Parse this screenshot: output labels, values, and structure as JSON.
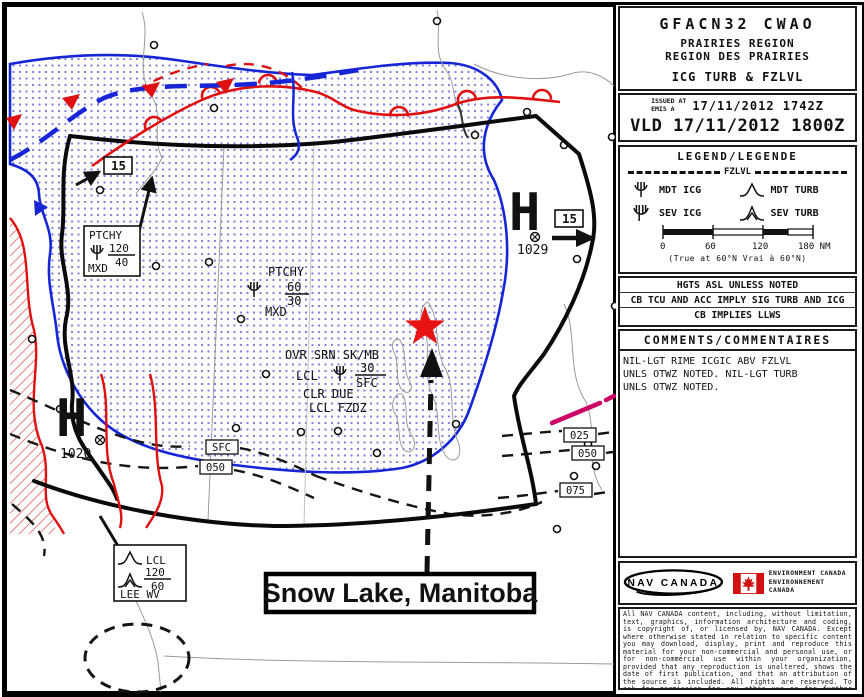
{
  "header": {
    "id": "GFACN32 CWAO",
    "region_en": "PRAIRIES REGION",
    "region_fr": "REGION DES PRAIRIES",
    "product": "ICG TURB & FZLVL",
    "issued_label": "ISSUED AT\nEMIS A",
    "issued_value": "17/11/2012 1742Z",
    "valid": "VLD 17/11/2012 1800Z"
  },
  "legend": {
    "title": "LEGEND/LEGENDE",
    "fzlvl": "FZLVL",
    "mdt_icg": "MDT ICG",
    "mdt_turb": "MDT TURB",
    "sev_icg": "SEV ICG",
    "sev_turb": "SEV TURB",
    "ticks": [
      "0",
      "60",
      "120",
      "180 NM"
    ],
    "note": "(True at 60°N    Vrai à 60°N)"
  },
  "notes": [
    "HGTS ASL UNLESS NOTED",
    "CB TCU AND ACC IMPLY SIG TURB AND ICG",
    "CB IMPLIES LLWS"
  ],
  "comments": {
    "title": "COMMENTS/COMMENTAIRES",
    "text": "NIL-LGT RIME ICGIC ABV FZLVL\nUNLS OTWZ NOTED. NIL-LGT TURB\nUNLS OTWZ NOTED."
  },
  "footer": {
    "nav": "NAV CANADA",
    "env_en": "ENVIRONMENT CANADA",
    "env_fr": "ENVIRONNEMENT CANADA",
    "fine_print": "All NAV CANADA content, including, without limitation, text, graphics, information architecture and coding, is copyright of, or licensed by, NAV CANADA. Except where otherwise stated in relation to specific content you may download, display, print and reproduce this material for your non-commercial and personal use, or for non-commercial use within your organization, provided that any reproduction is unaltered, shows the date of first publication, and that an attribution of the source is included. All rights are reserved. To ask for permission for any other use or for further information, please contact NAV CANADA at lanceaj@navcanada.ca."
  },
  "map": {
    "annotation": "Snow Lake, Manitoba",
    "flag_west": "15",
    "flag_east": "15",
    "high_west": {
      "sym": "H",
      "val": "1020"
    },
    "high_east": {
      "sym": "H",
      "val": "1029"
    },
    "ptchy_w": {
      "t": "PTCHY",
      "num": "120",
      "den": "40",
      "b": "MXD"
    },
    "ptchy_c": {
      "t": "PTCHY",
      "num": "60",
      "den": "30",
      "b": "MXD"
    },
    "ovr": {
      "l1": "OVR SRN SK/MB",
      "l2": "LCL",
      "num": "30",
      "den": "SFC",
      "l3": "CLR DUE",
      "l4": "LCL FZDZ"
    },
    "lee": {
      "l1": "LCL",
      "num": "120",
      "den": "60",
      "l3": "LEE WV"
    },
    "cw": [
      "SFC",
      "050"
    ],
    "ce": [
      "025",
      "050",
      "075"
    ]
  }
}
